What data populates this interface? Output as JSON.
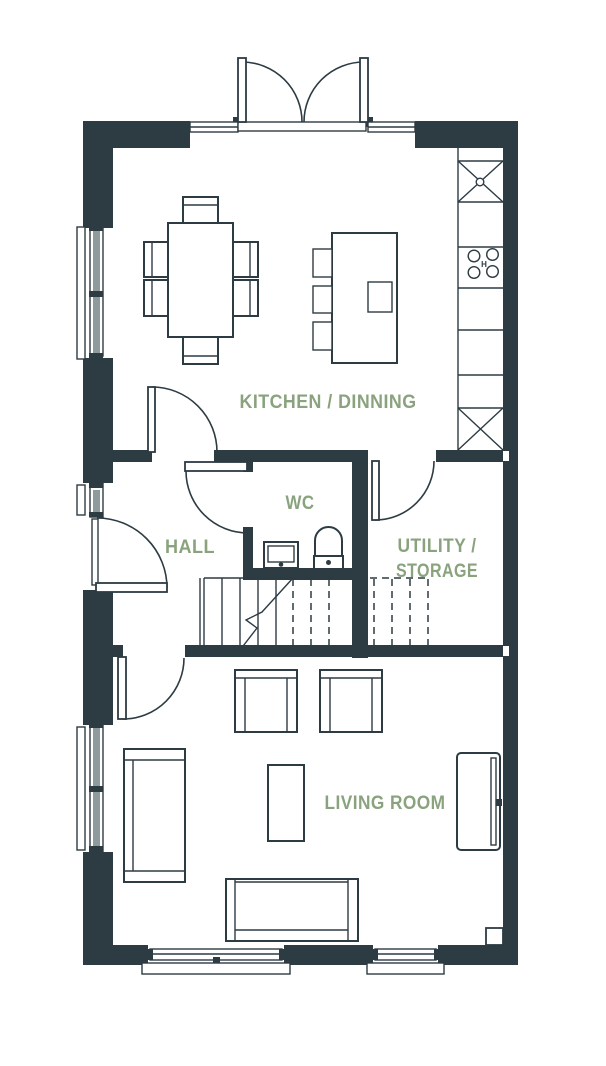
{
  "colors": {
    "wall": "#2d3b43",
    "accent": "#8aa37e",
    "glazing": "#8f9a9d"
  },
  "rooms": {
    "kitchen_dining": {
      "label": "KITCHEN / DINNING"
    },
    "wc": {
      "label": "WC"
    },
    "hall": {
      "label": "HALL"
    },
    "utility_storage": {
      "label_line1": "UTILITY /",
      "label_line2": "STORAGE"
    },
    "living_room": {
      "label": "LIVING ROOM"
    }
  },
  "kitchen": {
    "hob_label": "H"
  }
}
